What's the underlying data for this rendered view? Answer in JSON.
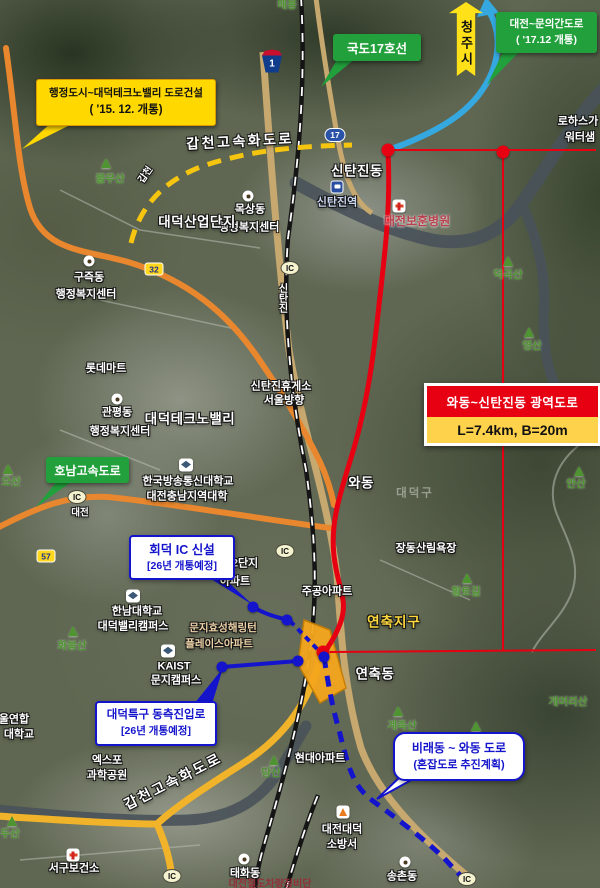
{
  "banner": {
    "text": "청주시"
  },
  "callouts": {
    "hjd": {
      "line1": "행정도시~대덕테크노밸리 도로건설",
      "line2": "( '15. 12. 개통)"
    },
    "route17": {
      "label": "국도17호선"
    },
    "muneui": {
      "line1": "대전~문의간도로",
      "line2": "( '17.12 개통)"
    },
    "honam": {
      "label": "호남고속도로"
    },
    "hoedeok": {
      "line1": "회덕 IC 신설",
      "line2": "[26년 개통예정]"
    },
    "teukgu": {
      "line1": "대덕특구 동측진입로",
      "line2": "[26년 개통예정]"
    },
    "birae": {
      "line1": "비래동 ~ 와동 도로",
      "line2": "(혼잡도로 추진계획)"
    }
  },
  "info_box": {
    "title": "와동~신탄진동 광역도로",
    "spec": "L=7.4km, B=20m"
  },
  "colors": {
    "route_red": "#e60012",
    "route_blue": "#1414cc",
    "planned_yellow": "#f6c50f",
    "highway_orange": "#e8872e",
    "callout_green": "#22a03c",
    "callout_yellow": "#ffd800",
    "zone_orange": "#f5a61d"
  },
  "map_labels": [
    {
      "t": "갑천고속화도로",
      "x": 240,
      "y": 141,
      "cls": "road",
      "rot": -3
    },
    {
      "t": "신탄진동",
      "x": 357,
      "y": 171,
      "cls": "lg"
    },
    {
      "t": "신탄진역",
      "x": 337,
      "y": 203,
      "cls": "blue"
    },
    {
      "t": "대전보훈병원",
      "x": 417,
      "y": 221,
      "cls": "red"
    },
    {
      "t": "목상동",
      "x": 250,
      "y": 210,
      "cls": "w"
    },
    {
      "t": "행정복지센터",
      "x": 249,
      "y": 228,
      "cls": "w"
    },
    {
      "t": "대덕산업단지",
      "x": 197,
      "y": 222,
      "cls": "lg"
    },
    {
      "t": "구즉동",
      "x": 89,
      "y": 278,
      "cls": "w"
    },
    {
      "t": "행정복지센터",
      "x": 86,
      "y": 295,
      "cls": "w"
    },
    {
      "t": "신탄진",
      "x": 281,
      "y": 298,
      "cls": "wv"
    },
    {
      "t": "불무산",
      "x": 110,
      "y": 179,
      "cls": "grn"
    },
    {
      "t": "갑천",
      "x": 146,
      "y": 175,
      "cls": "ws",
      "rot": -55
    },
    {
      "t": "매봉",
      "x": 287,
      "y": 5,
      "cls": "grn"
    },
    {
      "t": "로하스가",
      "x": 578,
      "y": 122,
      "cls": "w"
    },
    {
      "t": "워터샘",
      "x": 580,
      "y": 138,
      "cls": "w"
    },
    {
      "t": "덕곡산",
      "x": 508,
      "y": 275,
      "cls": "grn"
    },
    {
      "t": "영산",
      "x": 532,
      "y": 346,
      "cls": "grn"
    },
    {
      "t": "롯데마트",
      "x": 106,
      "y": 369,
      "cls": "w"
    },
    {
      "t": "대덕테크노밸리",
      "x": 190,
      "y": 419,
      "cls": "lg"
    },
    {
      "t": "신탄진휴게소",
      "x": 281,
      "y": 387,
      "cls": "w"
    },
    {
      "t": "서울방향",
      "x": 284,
      "y": 401,
      "cls": "w"
    },
    {
      "t": "관평동",
      "x": 117,
      "y": 413,
      "cls": "w"
    },
    {
      "t": "행정복지센터",
      "x": 120,
      "y": 432,
      "cls": "w"
    },
    {
      "t": "와동",
      "x": 361,
      "y": 483,
      "cls": "lg"
    },
    {
      "t": "대덕구",
      "x": 415,
      "y": 494,
      "cls": "faint"
    },
    {
      "t": "안산",
      "x": 576,
      "y": 484,
      "cls": "grn"
    },
    {
      "t": "오산",
      "x": 11,
      "y": 482,
      "cls": "grn"
    },
    {
      "t": "한국방송통신대학교",
      "x": 188,
      "y": 482,
      "cls": "w"
    },
    {
      "t": "대전충남지역대학",
      "x": 187,
      "y": 497,
      "cls": "w"
    },
    {
      "t": "대전",
      "x": 80,
      "y": 513,
      "cls": "ws"
    },
    {
      "t": "장동산림욕장",
      "x": 426,
      "y": 549,
      "cls": "w"
    },
    {
      "t": "황토길",
      "x": 466,
      "y": 592,
      "cls": "grn"
    },
    {
      "t": "주공아파트",
      "x": 327,
      "y": 592,
      "cls": "w"
    },
    {
      "t": "2단지",
      "x": 245,
      "y": 564,
      "cls": "w"
    },
    {
      "t": "아파트",
      "x": 235,
      "y": 582,
      "cls": "w"
    },
    {
      "t": "연축지구",
      "x": 394,
      "y": 622,
      "cls": "ylg"
    },
    {
      "t": "연축동",
      "x": 375,
      "y": 674,
      "cls": "lg"
    },
    {
      "t": "문지효성해링턴",
      "x": 223,
      "y": 628,
      "cls": "tan"
    },
    {
      "t": "플레이스아파트",
      "x": 219,
      "y": 644,
      "cls": "tan"
    },
    {
      "t": "한남대학교",
      "x": 137,
      "y": 612,
      "cls": "w"
    },
    {
      "t": "대덕밸리캠퍼스",
      "x": 133,
      "y": 627,
      "cls": "w"
    },
    {
      "t": "화봉산",
      "x": 72,
      "y": 646,
      "cls": "grn"
    },
    {
      "t": "KAIST",
      "x": 174,
      "y": 667,
      "cls": "w"
    },
    {
      "t": "문지캠퍼스",
      "x": 176,
      "y": 681,
      "cls": "w"
    },
    {
      "t": "울연합",
      "x": 14,
      "y": 720,
      "cls": "w"
    },
    {
      "t": "대학교",
      "x": 19,
      "y": 735,
      "cls": "w"
    },
    {
      "t": "계족산",
      "x": 402,
      "y": 726,
      "cls": "grn"
    },
    {
      "t": "개머리산",
      "x": 568,
      "y": 702,
      "cls": "grn"
    },
    {
      "t": "현대아파트",
      "x": 320,
      "y": 759,
      "cls": "w"
    },
    {
      "t": "당산",
      "x": 271,
      "y": 773,
      "cls": "grn"
    },
    {
      "t": "엑스포",
      "x": 107,
      "y": 761,
      "cls": "w"
    },
    {
      "t": "과학공원",
      "x": 107,
      "y": 776,
      "cls": "w"
    },
    {
      "t": "갑천고속화도로",
      "x": 173,
      "y": 781,
      "cls": "road",
      "rot": -27
    },
    {
      "t": "두산",
      "x": 10,
      "y": 834,
      "cls": "grn"
    },
    {
      "t": "서구보건소",
      "x": 74,
      "y": 869,
      "cls": "w"
    },
    {
      "t": "대전대덕",
      "x": 342,
      "y": 830,
      "cls": "w"
    },
    {
      "t": "소방서",
      "x": 342,
      "y": 845,
      "cls": "w"
    },
    {
      "t": "송촌동",
      "x": 402,
      "y": 877,
      "cls": "w"
    },
    {
      "t": "태화동",
      "x": 245,
      "y": 874,
      "cls": "w"
    },
    {
      "t": "대전철도차량정비단",
      "x": 270,
      "y": 885,
      "cls": "dred"
    }
  ],
  "markers": [
    {
      "k": "circle",
      "x": 248,
      "y": 196
    },
    {
      "k": "circle",
      "x": 89,
      "y": 261
    },
    {
      "k": "circle",
      "x": 117,
      "y": 399
    },
    {
      "k": "circle",
      "x": 405,
      "y": 862
    },
    {
      "k": "circle",
      "x": 244,
      "y": 859
    },
    {
      "k": "school",
      "x": 186,
      "y": 465
    },
    {
      "k": "school",
      "x": 133,
      "y": 596
    },
    {
      "k": "school",
      "x": 168,
      "y": 651
    },
    {
      "k": "cross",
      "x": 399,
      "y": 206
    },
    {
      "k": "cross",
      "x": 73,
      "y": 855
    },
    {
      "k": "fire",
      "x": 343,
      "y": 812
    },
    {
      "k": "train",
      "x": 337,
      "y": 187
    },
    {
      "k": "tri",
      "x": 106,
      "y": 163
    },
    {
      "k": "tri",
      "x": 8,
      "y": 469
    },
    {
      "k": "tri",
      "x": 579,
      "y": 471
    },
    {
      "k": "tri",
      "x": 529,
      "y": 332
    },
    {
      "k": "tri",
      "x": 467,
      "y": 578
    },
    {
      "k": "tri",
      "x": 73,
      "y": 631
    },
    {
      "k": "tri",
      "x": 398,
      "y": 711
    },
    {
      "k": "tri",
      "x": 274,
      "y": 760
    },
    {
      "k": "tri",
      "x": 12,
      "y": 821
    },
    {
      "k": "tri",
      "x": 476,
      "y": 726
    },
    {
      "k": "tri",
      "x": 508,
      "y": 261
    },
    {
      "k": "ic",
      "x": 290,
      "y": 268,
      "t": "IC"
    },
    {
      "k": "ic",
      "x": 77,
      "y": 497,
      "t": "IC"
    },
    {
      "k": "ic",
      "x": 285,
      "y": 551,
      "t": "IC"
    },
    {
      "k": "ic",
      "x": 172,
      "y": 876,
      "t": "IC"
    },
    {
      "k": "ic",
      "x": 467,
      "y": 879,
      "t": "IC"
    },
    {
      "k": "dot-red",
      "x": 388,
      "y": 150
    },
    {
      "k": "dot-red",
      "x": 503,
      "y": 152
    },
    {
      "k": "dot-red",
      "x": 323,
      "y": 652
    },
    {
      "k": "dot-blue",
      "x": 253,
      "y": 607
    },
    {
      "k": "dot-blue",
      "x": 287,
      "y": 620
    },
    {
      "k": "dot-blue",
      "x": 222,
      "y": 667
    },
    {
      "k": "dot-blue",
      "x": 298,
      "y": 661
    },
    {
      "k": "dot-blue",
      "x": 324,
      "y": 657
    }
  ],
  "shields": [
    {
      "kind": "ex",
      "num": "1",
      "x": 272,
      "y": 61
    },
    {
      "kind": "oval",
      "num": "17",
      "x": 335,
      "y": 135
    },
    {
      "kind": "rect",
      "num": "32",
      "x": 154,
      "y": 269
    },
    {
      "kind": "rect",
      "num": "57",
      "x": 46,
      "y": 556
    }
  ]
}
